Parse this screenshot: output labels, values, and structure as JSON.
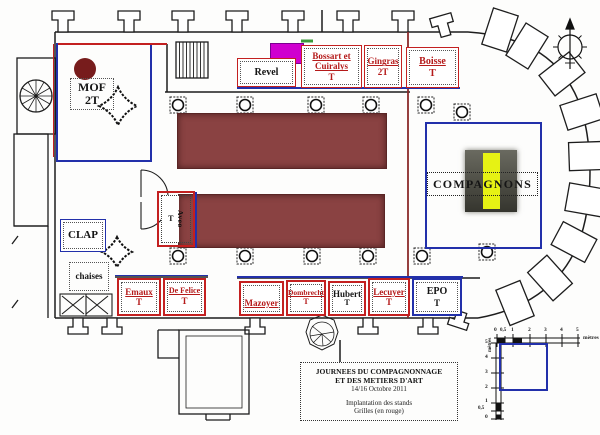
{
  "plan": {
    "stands": {
      "revel": {
        "name": "Revel"
      },
      "bossart": {
        "name_line1": "Bossart et",
        "name_line2": "Cuiralys",
        "tables": "T"
      },
      "gingras": {
        "name": "Gingras",
        "tables": "2T"
      },
      "boisse": {
        "name": "Boisse",
        "tables": "T"
      },
      "mof": {
        "name": "MOF",
        "tables": "2T"
      },
      "clap": {
        "name": "CLAP"
      },
      "chaises": {
        "name": "chaises"
      },
      "aveo": {
        "name": "Aveo",
        "tables": "T"
      },
      "emaux": {
        "name": "Emaux",
        "tables": "T"
      },
      "de_felice": {
        "name": "De Felice",
        "tables": "T"
      },
      "mazoyer": {
        "name": "Mazoyer"
      },
      "dombrecht": {
        "name": "Dombrecht",
        "tables": "T"
      },
      "hubert": {
        "name": "Hubert",
        "tables": "T"
      },
      "lecuyer": {
        "name": "Lecuyer",
        "tables": "T"
      },
      "epo": {
        "name": "EPO",
        "tables": "T"
      },
      "compagnons": {
        "name": "COMPAGNONS"
      }
    },
    "legend": {
      "title_line1": "JOURNEES DU COMPAGNONNAGE",
      "title_line2": "ET DES METIERS D'ART",
      "date": "14/16 Octobre 2011",
      "note_line1": "Implantation des stands",
      "note_line2": "Grilles (en rouge)"
    },
    "scale": {
      "ticks": [
        "0",
        "0,5",
        "1",
        "2",
        "3",
        "4",
        "5"
      ],
      "unit": "mètres"
    },
    "colors": {
      "grille_red": "#c32020",
      "zone_blue": "#2230aa",
      "nave_fill": "#8a4242",
      "magenta": "#cf00cf",
      "altar_yellow": "#e6f214",
      "mof_dot": "#771c1c"
    }
  }
}
